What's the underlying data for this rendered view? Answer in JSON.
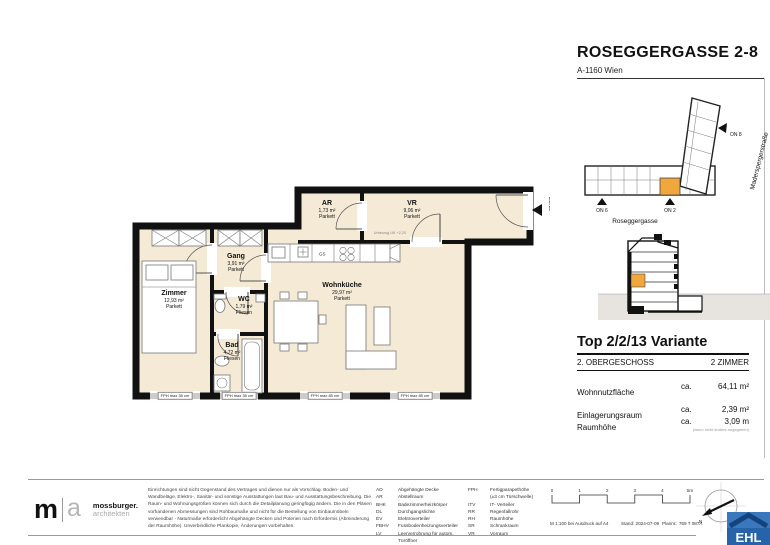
{
  "header": {
    "title": "ROSEGGERGASSE 2-8",
    "subtitle": "A-1160 Wien"
  },
  "site_plan": {
    "street_vertical": "Maderspergerstraße",
    "street_bottom": "Roseggergasse",
    "on6": "ON 6",
    "on2": "ON 2",
    "on8": "ON 8",
    "highlight_color": "#EFA73E"
  },
  "info_panel": {
    "title": "Top 2/2/13 Variante",
    "floor": "2. OBERGESCHOSS",
    "rooms_count": "2 ZIMMER",
    "rows": [
      {
        "label": "Wohnnutzfläche",
        "ca": "ca.",
        "value": "64,11 m²"
      },
      {
        "label": "Einlagerungsraum",
        "ca": "ca.",
        "value": "2,39 m²"
      },
      {
        "label": "Raumhöhe",
        "ca": "ca.",
        "value": "3,09 m"
      }
    ],
    "note": "(wenn nicht anders angegeben)"
  },
  "floor_plan": {
    "unit_marker": "2/2/13",
    "kitchen_gs": "GS",
    "beam_note": "Unterzug UK +2,20",
    "rooms": [
      {
        "name": "Zimmer",
        "area": "12,93 m²",
        "floor": "Parkett"
      },
      {
        "name": "Gang",
        "area": "3,91 m²",
        "floor": "Parkett"
      },
      {
        "name": "WC",
        "area": "1,79 m²",
        "floor": "Fliesen"
      },
      {
        "name": "Bad",
        "area": "4,72 m²",
        "floor": "Fliesen"
      },
      {
        "name": "Wohnküche",
        "area": "29,97 m²",
        "floor": "Parkett"
      },
      {
        "name": "AR",
        "area": "1,73 m²",
        "floor": "Parkett"
      },
      {
        "name": "VR",
        "area": "9,06 m²",
        "floor": "Parkett"
      }
    ],
    "window_labels": [
      "FPH max 35 cm",
      "FPH max 35 cm",
      "FPH max 85 cm",
      "FPH max 85 cm"
    ]
  },
  "footer": {
    "logo": {
      "m": "m",
      "a": "a",
      "name": "mossburger.",
      "sub": "architekten"
    },
    "legal": "Einrichtungen sind nicht Gegenstand des Vertrages und dienen nur als Vorschlag. Boden- und Wandbeläge, Elektro-, Sanitär- und sonstige Ausstattungen laut Bau- und Ausstattungsbeschreibung. Die Raum- und Wohnungsgrößen können sich durch die Detailplanung geringfügig ändern. Die in den Plänen vorhandenen Abmessungen sind Rohbaumaße und nicht für die Bestellung von Einbaumöbeln verwendbar - Naturmaße erforderlich! Abgehängte Decken und Poterien nach Erfordernis (Abminderung der Raumhöhe). Unverbindliche Plankopie, Änderungen vorbehalten.",
    "abbr_left": [
      {
        "k": "AD",
        "v": "Abgehängte Decke"
      },
      {
        "k": "AR",
        "v": "Abstellraum"
      },
      {
        "k": "BHK",
        "v": "Badezimmerheizkörper"
      },
      {
        "k": "DL",
        "v": "Durchgangslichte"
      },
      {
        "k": "EV",
        "v": "Elektroverteiler"
      },
      {
        "k": "FBHV",
        "v": "Fussbodenheizungsverteiler"
      },
      {
        "k": "LV",
        "v": "Leerverrohrung für autom. Türöffner"
      }
    ],
    "abbr_right": [
      {
        "k": "FPH",
        "v": "Fertigparapethöhe"
      },
      {
        "k": "",
        "v": "(±3 cm Türschwelle)"
      },
      {
        "k": "ITV",
        "v": "IT- Verteiler"
      },
      {
        "k": "RR",
        "v": "Regenfallrohr"
      },
      {
        "k": "RH",
        "v": "Raumhöhe"
      },
      {
        "k": "SR",
        "v": "Schrankraum"
      },
      {
        "k": "VR",
        "v": "Vorraum"
      }
    ],
    "scale_ticks": [
      "0",
      "1",
      "2",
      "3",
      "4",
      "5m"
    ],
    "stamp": {
      "scale": "M 1:100 bei Ausdruck auf A4",
      "date": "Stand: 2024-07-09",
      "plan_no": "Plannr.: 769 T 087A"
    },
    "compass_n": "N",
    "ehl": "EHL"
  }
}
